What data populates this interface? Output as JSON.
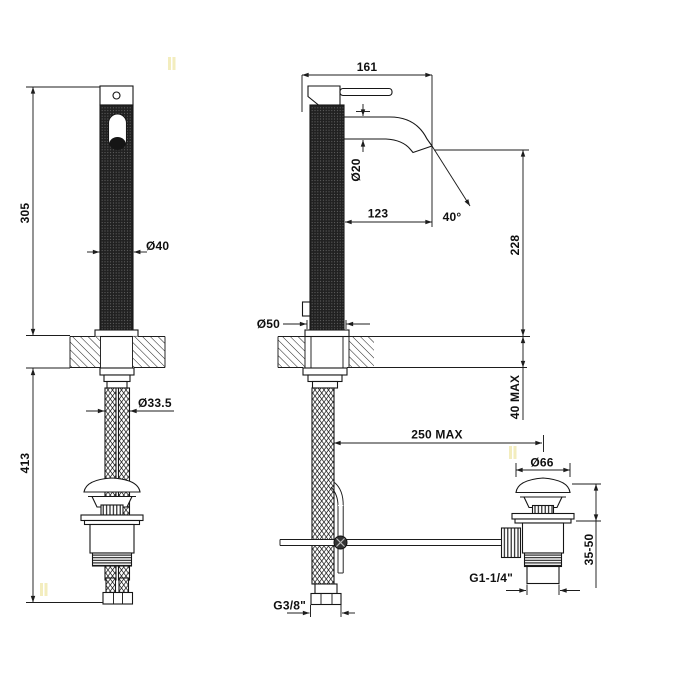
{
  "drawing": {
    "kind": "technical-dimension-drawing",
    "subject": "tall single-lever basin mixer with knurled body, flexible supply hoses and pop-up waste",
    "line_color": "#1d1d1d",
    "background": "#ffffff"
  },
  "dims": {
    "front": {
      "height_above_deck": "305",
      "body_diameter": "Ø40",
      "hose_bundle_diameter": "Ø33.5",
      "length_below_deck": "413"
    },
    "side": {
      "overall_depth": "161",
      "spout_diameter": "Ø20",
      "spout_reach": "123",
      "spout_angle": "40°",
      "spout_outlet_height": "228",
      "base_diameter": "Ø50",
      "deck_thickness_max": "40 MAX",
      "waste_offset_max": "250 MAX"
    },
    "waste": {
      "cap_diameter": "Ø66",
      "adjust_range": "35-50",
      "outlet_thread": "G1-1/4\""
    },
    "supply": {
      "hose_thread": "G3/8\""
    }
  }
}
